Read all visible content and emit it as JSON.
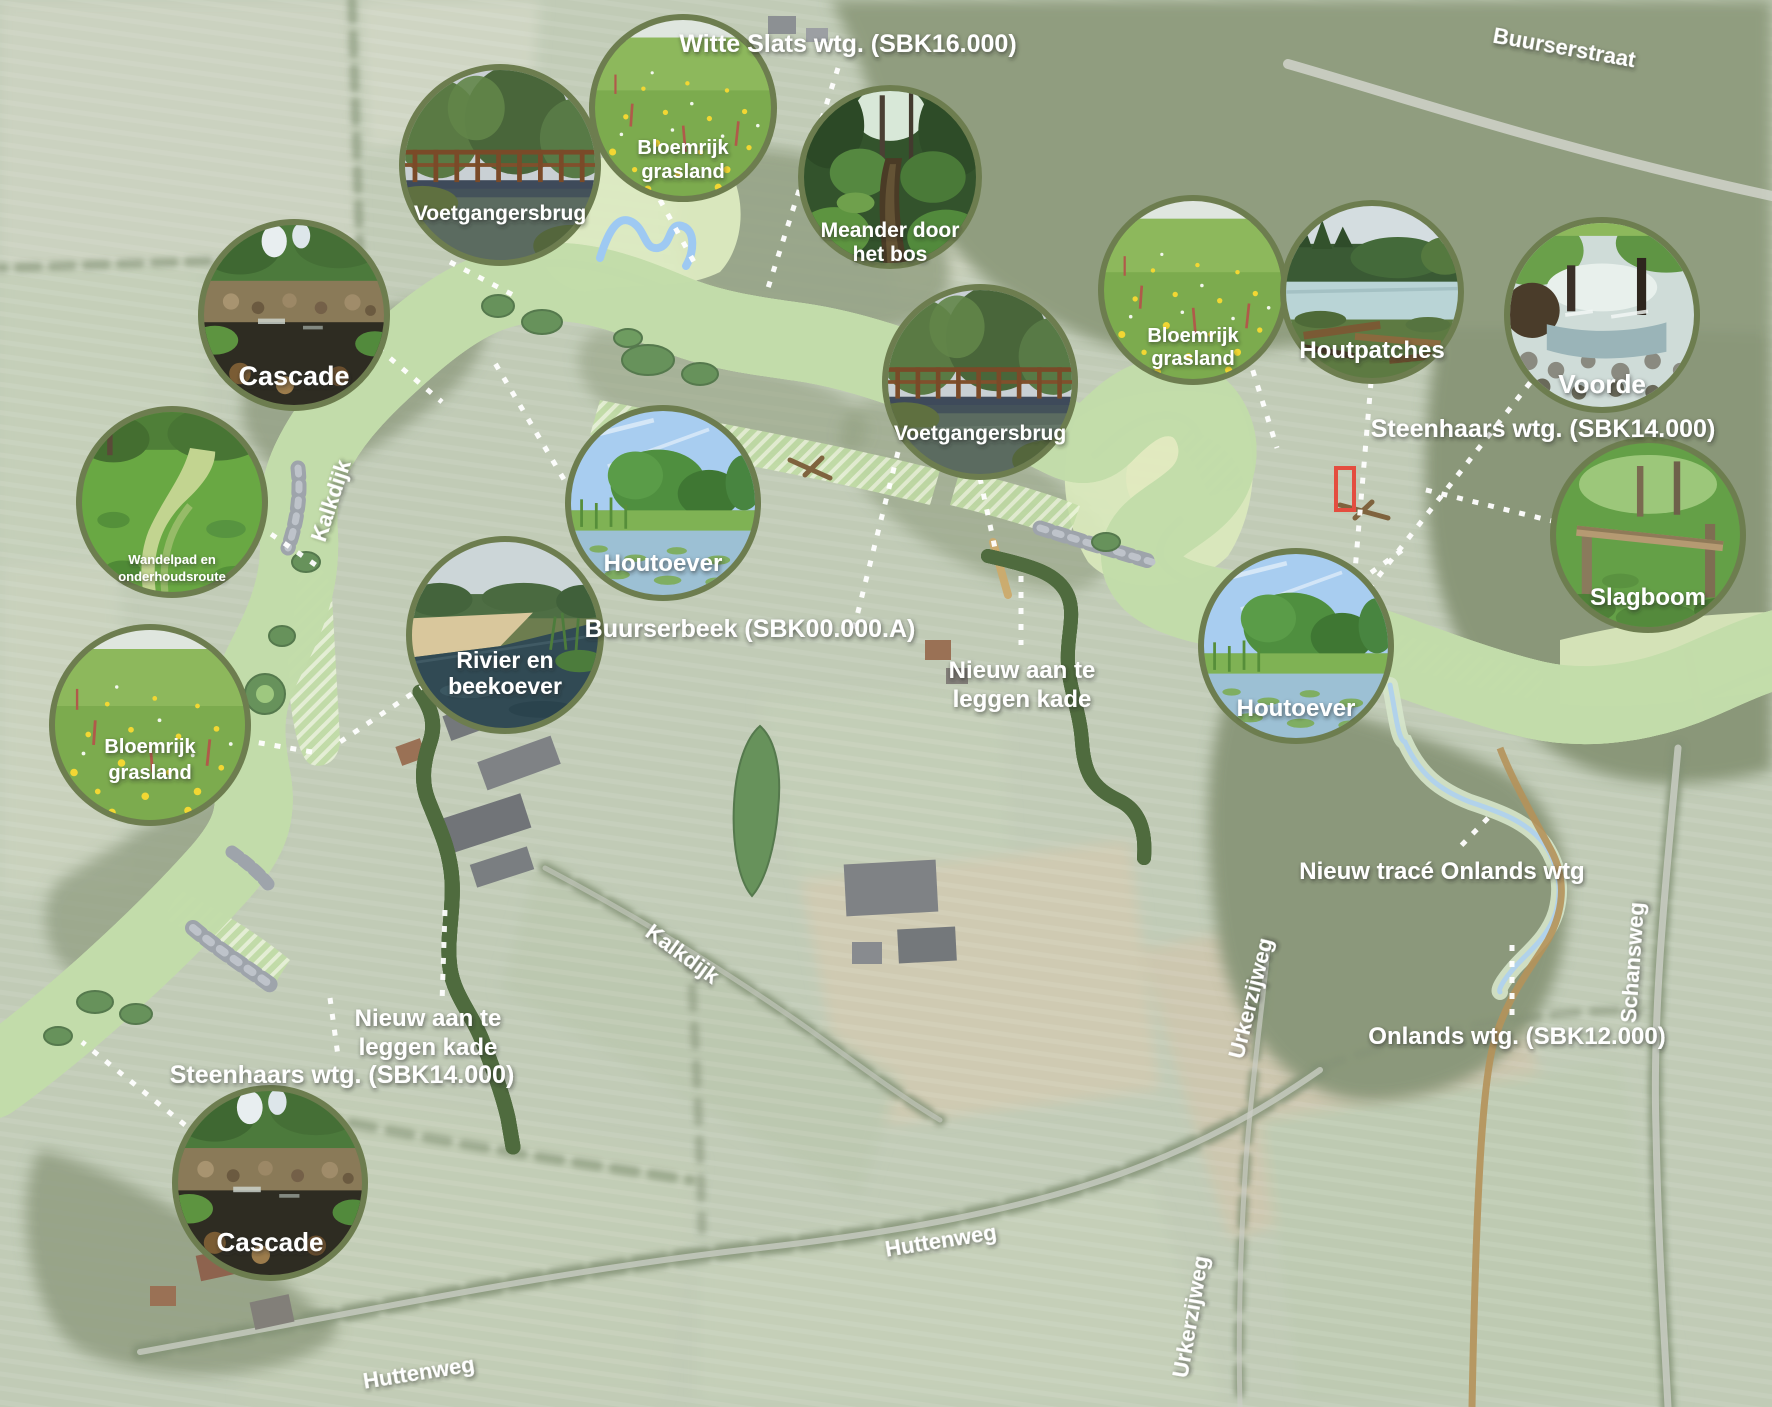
{
  "title": "Buurserbeek herinrichting plankaart",
  "colors": {
    "field_base": "#b7c3ab",
    "forest": "#7c8b69",
    "forest_dark": "#68795a",
    "plan_floodplain": "#cfe3ae",
    "plan_corridor": "#aed18c",
    "river_blue": "#74aaed",
    "river_blue_light": "#8abaf2",
    "dike_tan": "#c49d55",
    "kade_green": "#8dc63f",
    "kade_outline": "#33531f",
    "stone_grey": "#9aa0a8",
    "label_white": "#ffffff",
    "inset_border": "#6d7d4f",
    "red_marker": "#e03020",
    "onlands_stream": "#a5cbe8"
  },
  "road_labels": [
    {
      "id": "buurserstraat",
      "text": "Buurserstraat",
      "x": 1563,
      "y": 55,
      "rot": 10,
      "size": 22
    },
    {
      "id": "kalkdijk-north",
      "text": "Kalkdijk",
      "x": 338,
      "y": 503,
      "rot": -72,
      "size": 22
    },
    {
      "id": "kalkdijk-south",
      "text": "Kalkdijk",
      "x": 678,
      "y": 960,
      "rot": 36,
      "size": 22
    },
    {
      "id": "huttenweg-west",
      "text": "Huttenweg",
      "x": 420,
      "y": 1380,
      "rot": -9,
      "size": 22
    },
    {
      "id": "huttenweg-mid",
      "text": "Huttenweg",
      "x": 942,
      "y": 1248,
      "rot": -9,
      "size": 22
    },
    {
      "id": "urkerzijweg-north",
      "text": "Urkerzijweg",
      "x": 1258,
      "y": 1000,
      "rot": -76,
      "size": 22
    },
    {
      "id": "urkerzijweg-south",
      "text": "Urkerzijweg",
      "x": 1198,
      "y": 1318,
      "rot": -80,
      "size": 22
    },
    {
      "id": "schansweg",
      "text": "Schansweg",
      "x": 1640,
      "y": 963,
      "rot": -86,
      "size": 22
    }
  ],
  "annotations": [
    {
      "id": "witte-slats-wtg",
      "lines": [
        "Witte Slats wtg. (SBK16.000)"
      ],
      "x": 848,
      "y": 52,
      "size": 25
    },
    {
      "id": "steenhaars-wtg-east",
      "lines": [
        "Steenhaars wtg. (SBK14.000)"
      ],
      "x": 1543,
      "y": 437,
      "size": 25
    },
    {
      "id": "buurserbeek",
      "lines": [
        "Buurserbeek (SBK00.000.A)"
      ],
      "x": 750,
      "y": 637,
      "size": 25
    },
    {
      "id": "nieuw-kade-mid",
      "lines": [
        "Nieuw aan te",
        "leggen kade"
      ],
      "x": 1022,
      "y": 678,
      "size": 24
    },
    {
      "id": "nieuw-trace-onlands",
      "lines": [
        "Nieuw tracé Onlands wtg"
      ],
      "x": 1442,
      "y": 879,
      "size": 24
    },
    {
      "id": "onlands-wtg",
      "lines": [
        "Onlands wtg. (SBK12.000)"
      ],
      "x": 1517,
      "y": 1044,
      "size": 24
    },
    {
      "id": "nieuw-kade-west",
      "lines": [
        "Nieuw aan te",
        "leggen kade"
      ],
      "x": 428,
      "y": 1026,
      "size": 24
    },
    {
      "id": "steenhaars-wtg-west",
      "lines": [
        "Steenhaars wtg. (SBK14.000)"
      ],
      "x": 342,
      "y": 1083,
      "size": 25
    }
  ],
  "insets": [
    {
      "id": "voetgangersbrug-nw",
      "photo": "bridge",
      "cx": 500,
      "cy": 165,
      "r": 95,
      "size": 21,
      "labels": [
        {
          "t": "Voetgangersbrug",
          "dy": 55
        }
      ]
    },
    {
      "id": "bloemrijk-grasland-n",
      "photo": "meadow",
      "cx": 683,
      "cy": 108,
      "r": 88,
      "size": 20,
      "labels": [
        {
          "t": "Bloemrijk",
          "dy": 46
        },
        {
          "t": "grasland",
          "dy": 70
        }
      ]
    },
    {
      "id": "meander-door-het-bos",
      "photo": "forest-stream",
      "cx": 890,
      "cy": 177,
      "r": 86,
      "size": 21,
      "labels": [
        {
          "t": "Meander door",
          "dy": 60
        },
        {
          "t": "het bos",
          "dy": 84
        }
      ]
    },
    {
      "id": "cascade-n",
      "photo": "cascade",
      "cx": 294,
      "cy": 315,
      "r": 90,
      "size": 27,
      "labels": [
        {
          "t": "Cascade",
          "dy": 70
        }
      ]
    },
    {
      "id": "wandelpad",
      "photo": "path",
      "cx": 172,
      "cy": 502,
      "r": 90,
      "size": 13,
      "labels": [
        {
          "t": "Wandelpad en",
          "dy": 62
        },
        {
          "t": "onderhoudsroute",
          "dy": 79
        }
      ]
    },
    {
      "id": "bloemrijk-grasland-w",
      "photo": "meadow",
      "cx": 150,
      "cy": 725,
      "r": 95,
      "size": 20,
      "labels": [
        {
          "t": "Bloemrijk",
          "dy": 28
        },
        {
          "t": "grasland",
          "dy": 54
        }
      ]
    },
    {
      "id": "rivier-en-beekoever",
      "photo": "riverbank",
      "cx": 505,
      "cy": 635,
      "r": 93,
      "size": 23,
      "labels": [
        {
          "t": "Rivier en",
          "dy": 33
        },
        {
          "t": "beekoever",
          "dy": 59
        }
      ]
    },
    {
      "id": "houtoever-mid",
      "photo": "houtoever",
      "cx": 663,
      "cy": 503,
      "r": 92,
      "size": 24,
      "labels": [
        {
          "t": "Houtoever",
          "dy": 68
        }
      ]
    },
    {
      "id": "voetgangersbrug-mid",
      "photo": "bridge",
      "cx": 980,
      "cy": 382,
      "r": 92,
      "size": 21,
      "labels": [
        {
          "t": "Voetgangersbrug",
          "dy": 58
        }
      ]
    },
    {
      "id": "bloemrijk-grasland-e",
      "photo": "meadow",
      "cx": 1193,
      "cy": 290,
      "r": 89,
      "size": 20,
      "labels": [
        {
          "t": "Bloemrijk",
          "dy": 52
        },
        {
          "t": "grasland",
          "dy": 75
        }
      ]
    },
    {
      "id": "houtpatches",
      "photo": "houtpatches",
      "cx": 1372,
      "cy": 292,
      "r": 86,
      "size": 24,
      "labels": [
        {
          "t": "Houtpatches",
          "dy": 66
        }
      ]
    },
    {
      "id": "voorde",
      "photo": "voorde",
      "cx": 1602,
      "cy": 315,
      "r": 92,
      "size": 26,
      "labels": [
        {
          "t": "Voorde",
          "dy": 78
        }
      ]
    },
    {
      "id": "slagboom",
      "photo": "slagboom",
      "cx": 1648,
      "cy": 535,
      "r": 92,
      "size": 24,
      "labels": [
        {
          "t": "Slagboom",
          "dy": 70
        }
      ]
    },
    {
      "id": "houtoever-e",
      "photo": "houtoever",
      "cx": 1296,
      "cy": 646,
      "r": 92,
      "size": 24,
      "labels": [
        {
          "t": "Houtoever",
          "dy": 70
        }
      ]
    },
    {
      "id": "cascade-s",
      "photo": "cascade",
      "cx": 270,
      "cy": 1183,
      "r": 92,
      "size": 26,
      "labels": [
        {
          "t": "Cascade",
          "dy": 68
        }
      ]
    }
  ],
  "leaders": [
    {
      "id": "ld-voetgangersbrug-nw",
      "pts": [
        [
          450,
          262
        ],
        [
          515,
          296
        ]
      ]
    },
    {
      "id": "ld-bloemrijk-n",
      "pts": [
        [
          660,
          200
        ],
        [
          694,
          262
        ]
      ]
    },
    {
      "id": "ld-witte-slats",
      "pts": [
        [
          838,
          68
        ],
        [
          768,
          288
        ]
      ]
    },
    {
      "id": "ld-cascade-n",
      "pts": [
        [
          378,
          348
        ],
        [
          442,
          402
        ]
      ]
    },
    {
      "id": "ld-wandelpad",
      "pts": [
        [
          258,
          525
        ],
        [
          320,
          568
        ]
      ]
    },
    {
      "id": "ld-bloemrijk-w",
      "pts": [
        [
          243,
          740
        ],
        [
          312,
          752
        ]
      ]
    },
    {
      "id": "ld-rivier-beekoever",
      "pts": [
        [
          425,
          685
        ],
        [
          340,
          742
        ]
      ]
    },
    {
      "id": "ld-houtoever-mid",
      "pts": [
        [
          572,
          493
        ],
        [
          492,
          358
        ]
      ]
    },
    {
      "id": "ld-voetgangersbrug-mid",
      "pts": [
        [
          980,
          478
        ],
        [
          996,
          553
        ]
      ]
    },
    {
      "id": "ld-bloemrijk-e",
      "pts": [
        [
          1248,
          355
        ],
        [
          1277,
          448
        ]
      ]
    },
    {
      "id": "ld-houtpatches",
      "pts": [
        [
          1371,
          382
        ],
        [
          1350,
          630
        ]
      ]
    },
    {
      "id": "ld-voorde",
      "pts": [
        [
          1540,
          370
        ],
        [
          1360,
          600
        ]
      ]
    },
    {
      "id": "ld-slagboom",
      "pts": [
        [
          1556,
          522
        ],
        [
          1418,
          488
        ]
      ]
    },
    {
      "id": "ld-houtoever-e",
      "pts": [
        [
          1358,
          582
        ],
        [
          1408,
          546
        ]
      ]
    },
    {
      "id": "ld-cascade-s",
      "pts": [
        [
          185,
          1125
        ],
        [
          82,
          1042
        ]
      ]
    },
    {
      "id": "ld-buurserbeek",
      "pts": [
        [
          898,
          452
        ],
        [
          852,
          636
        ]
      ]
    },
    {
      "id": "ld-kade-mid",
      "pts": [
        [
          1021,
          576
        ],
        [
          1021,
          645
        ]
      ]
    },
    {
      "id": "ld-kade-west",
      "pts": [
        [
          445,
          910
        ],
        [
          442,
          1003
        ]
      ]
    },
    {
      "id": "ld-steenhaars-west",
      "pts": [
        [
          330,
          998
        ],
        [
          338,
          1056
        ]
      ]
    },
    {
      "id": "ld-nieuw-trace",
      "pts": [
        [
          1488,
          818
        ],
        [
          1455,
          852
        ]
      ]
    },
    {
      "id": "ld-onlands",
      "pts": [
        [
          1512,
          945
        ],
        [
          1512,
          1020
        ]
      ]
    }
  ]
}
